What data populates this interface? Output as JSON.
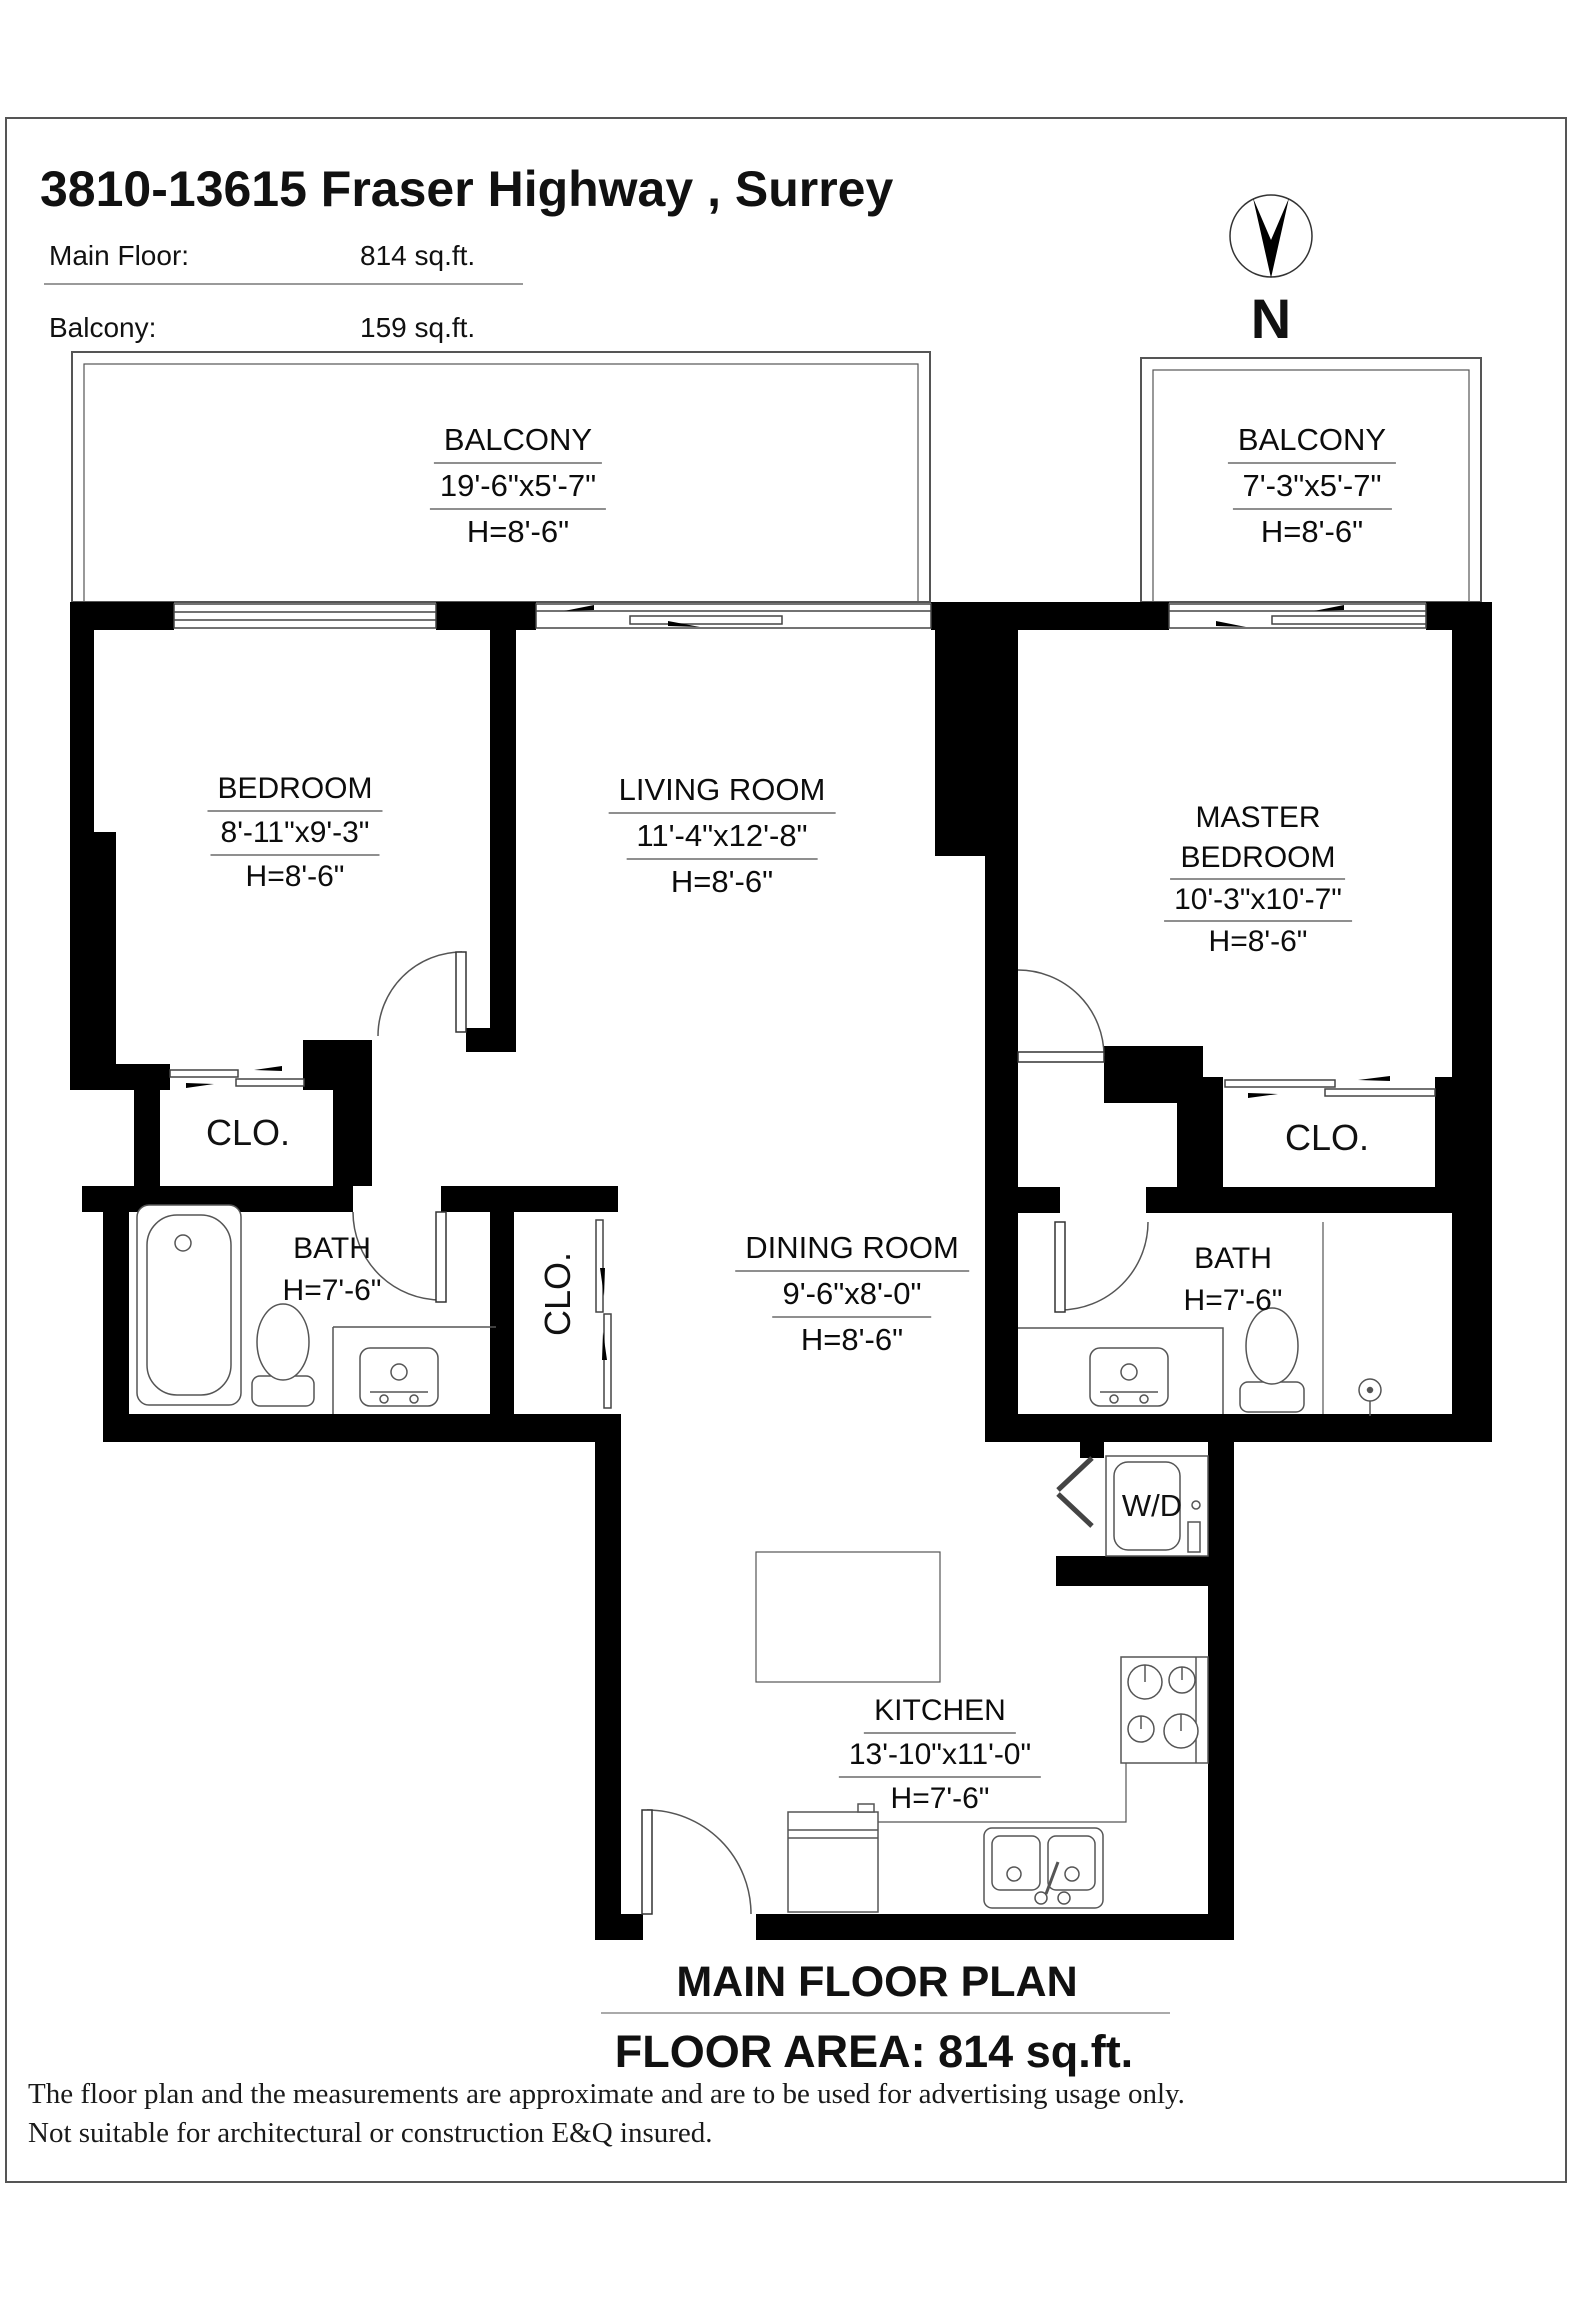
{
  "header": {
    "title": "3810-13615 Fraser Highway , Surrey",
    "main_floor_label": "Main Floor:",
    "main_floor_value": "814 sq.ft.",
    "balcony_label": "Balcony:",
    "balcony_value": "159 sq.ft."
  },
  "compass": {
    "label": "N"
  },
  "rooms": {
    "balcony_left": {
      "name": "BALCONY",
      "dims": "19'-6\"x5'-7\"",
      "height": "H=8'-6\""
    },
    "balcony_right": {
      "name": "BALCONY",
      "dims": "7'-3\"x5'-7\"",
      "height": "H=8'-6\""
    },
    "bedroom": {
      "name": "BEDROOM",
      "dims": "8'-11\"x9'-3\"",
      "height": "H=8'-6\""
    },
    "living_room": {
      "name": "LIVING ROOM",
      "dims": "11'-4\"x12'-8\"",
      "height": "H=8'-6\""
    },
    "master_bedroom": {
      "name_line1": "MASTER",
      "name_line2": "BEDROOM",
      "dims": "10'-3\"x10'-7\"",
      "height": "H=8'-6\""
    },
    "dining_room": {
      "name": "DINING ROOM",
      "dims": "9'-6\"x8'-0\"",
      "height": "H=8'-6\""
    },
    "kitchen": {
      "name": "KITCHEN",
      "dims": "13'-10\"x11'-0\"",
      "height": "H=7'-6\""
    },
    "bath_left": {
      "name": "BATH",
      "height": "H=7'-6\""
    },
    "bath_right": {
      "name": "BATH",
      "height": "H=7'-6\""
    },
    "closet_left": {
      "name": "CLO."
    },
    "closet_right": {
      "name": "CLO."
    },
    "closet_hall": {
      "name": "CLO."
    },
    "laundry": {
      "name": "W/D"
    }
  },
  "footer": {
    "plan_title": "MAIN FLOOR PLAN",
    "floor_area": "FLOOR AREA: 814 sq.ft.",
    "disclaimer_line1": "The floor plan and the measurements are approximate and are to be used for advertising usage only.",
    "disclaimer_line2": "Not suitable for architectural or construction E&Q insured."
  }
}
